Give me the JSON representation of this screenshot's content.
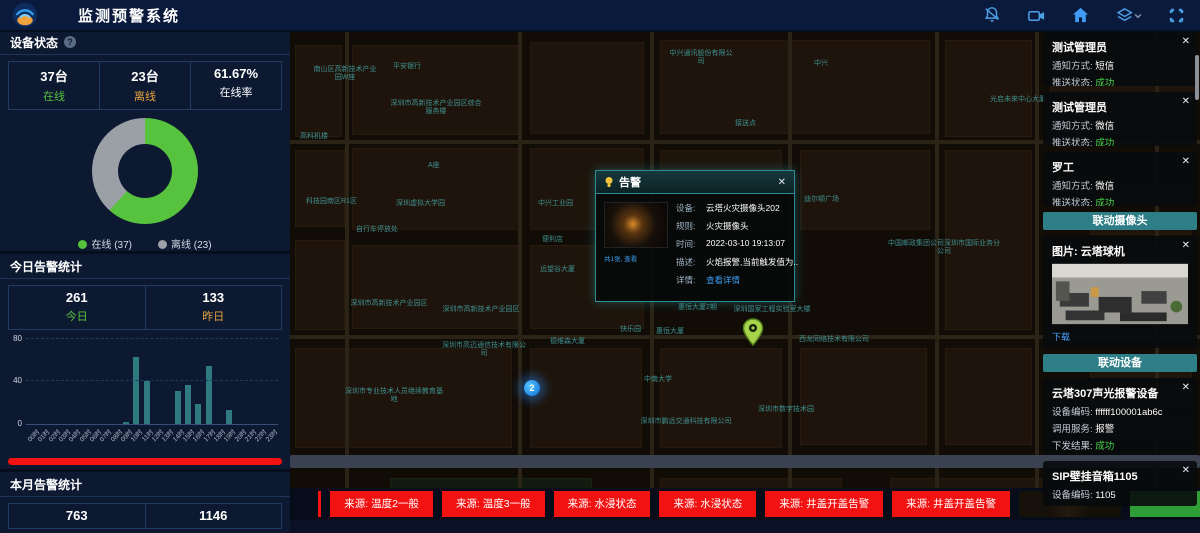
{
  "header": {
    "title": "监测预警系统",
    "icons": [
      {
        "name": "bell-off-icon"
      },
      {
        "name": "video-camera-icon"
      },
      {
        "name": "home-icon"
      },
      {
        "name": "layers-icon"
      },
      {
        "name": "fullscreen-icon"
      }
    ]
  },
  "device_status": {
    "title": "设备状态",
    "stats": [
      {
        "value": "37台",
        "label": "在线",
        "color": "#56c23d"
      },
      {
        "value": "23台",
        "label": "离线",
        "color": "#e8a33d"
      },
      {
        "value": "61.67%",
        "label": "在线率",
        "color": "#ffffff"
      }
    ]
  },
  "today_alerts": {
    "title": "今日告警统计",
    "stats": [
      {
        "value": "261",
        "label": "今日",
        "color": "#56c23d"
      },
      {
        "value": "133",
        "label": "昨日",
        "color": "#e8a33d"
      }
    ],
    "unhandled": "未处理(261个)",
    "handled": "已处理(0个)",
    "unhandled_color": "#f51212",
    "handled_color": "#49d349"
  },
  "month_alerts": {
    "title": "本月告警统计",
    "values": [
      "763",
      "1146"
    ]
  },
  "chart_data": [
    {
      "type": "pie",
      "donut": true,
      "title": "设备状态",
      "labels": [
        "在线",
        "离线"
      ],
      "values": [
        37,
        23
      ],
      "colors": [
        "#56c23d",
        "#9aa0a6"
      ],
      "legend": [
        "在线 (37)",
        "离线 (23)"
      ],
      "legend_position": "bottom"
    },
    {
      "type": "bar",
      "title": "今日告警统计(按小时)",
      "categories": [
        "00时",
        "01时",
        "02时",
        "03时",
        "04时",
        "05时",
        "06时",
        "07时",
        "08时",
        "09时",
        "10时",
        "11时",
        "12时",
        "13时",
        "14时",
        "15时",
        "16时",
        "17时",
        "18时",
        "19时",
        "20时",
        "21时",
        "22时",
        "23时"
      ],
      "values": [
        0,
        0,
        0,
        0,
        0,
        0,
        0,
        0,
        0,
        2,
        62,
        40,
        0,
        0,
        31,
        36,
        19,
        54,
        0,
        13,
        0,
        0,
        0,
        0
      ],
      "xlabel": "",
      "ylabel": "",
      "ylim": [
        0,
        80
      ],
      "yticks": [
        0,
        40,
        80
      ],
      "color": "#2e7a80",
      "grid": "dashed"
    }
  ],
  "map": {
    "cluster_count": "2",
    "labels": [
      {
        "x": 22,
        "y": 36,
        "w": 66,
        "t": "南山区高新技术产业园W座"
      },
      {
        "x": 103,
        "y": 33,
        "w": 0,
        "t": "平安银行"
      },
      {
        "x": 100,
        "y": 70,
        "w": 92,
        "t": "深圳市高新技术产业园区综合服务楼"
      },
      {
        "x": 10,
        "y": 103,
        "w": 0,
        "t": "高科机楼"
      },
      {
        "x": 16,
        "y": 168,
        "w": 0,
        "t": "科技园南区R1区"
      },
      {
        "x": 138,
        "y": 132,
        "w": 0,
        "t": "A座"
      },
      {
        "x": 106,
        "y": 170,
        "w": 0,
        "t": "深圳虚拟大学园"
      },
      {
        "x": 66,
        "y": 196,
        "w": 0,
        "t": "自行车停放处"
      },
      {
        "x": 248,
        "y": 170,
        "w": 0,
        "t": "中兴工业园"
      },
      {
        "x": 252,
        "y": 206,
        "w": 0,
        "t": "便利店"
      },
      {
        "x": 250,
        "y": 236,
        "w": 0,
        "t": "远望谷大厦"
      },
      {
        "x": 378,
        "y": 20,
        "w": 66,
        "t": "中兴通讯股份有限公司"
      },
      {
        "x": 524,
        "y": 30,
        "w": 0,
        "t": "中兴"
      },
      {
        "x": 700,
        "y": 66,
        "w": 0,
        "t": "光启未来中心大厦"
      },
      {
        "x": 445,
        "y": 90,
        "w": 0,
        "t": "接送点"
      },
      {
        "x": 58,
        "y": 270,
        "w": 82,
        "t": "深圳市高新技术产业园区"
      },
      {
        "x": 150,
        "y": 276,
        "w": 82,
        "t": "深圳市高新技术产业园区"
      },
      {
        "x": 55,
        "y": 358,
        "w": 98,
        "t": "深圳市专业技术人员继续教育基地"
      },
      {
        "x": 152,
        "y": 312,
        "w": 84,
        "t": "深圳市高迈通信技术有限公司"
      },
      {
        "x": 260,
        "y": 308,
        "w": 0,
        "t": "德维森大厦"
      },
      {
        "x": 330,
        "y": 296,
        "w": 0,
        "t": "快乐园"
      },
      {
        "x": 366,
        "y": 298,
        "w": 0,
        "t": "惠恒大厦"
      },
      {
        "x": 388,
        "y": 274,
        "w": 0,
        "t": "惠恒大厦2期"
      },
      {
        "x": 440,
        "y": 276,
        "w": 84,
        "t": "深圳国家工程实验室大楼"
      },
      {
        "x": 354,
        "y": 346,
        "w": 0,
        "t": "中南大学"
      },
      {
        "x": 350,
        "y": 388,
        "w": 92,
        "t": "深圳市鹏远交通科技有限公司"
      },
      {
        "x": 468,
        "y": 376,
        "w": 0,
        "t": "深圳市数字技术园"
      },
      {
        "x": 508,
        "y": 306,
        "w": 72,
        "t": "西龙同络技术有限公司"
      },
      {
        "x": 598,
        "y": 210,
        "w": 112,
        "t": "中国邮政集团公司深圳市国际业务分公司"
      },
      {
        "x": 514,
        "y": 166,
        "w": 0,
        "t": "迪尔顿广场"
      }
    ]
  },
  "popup": {
    "title": "告警",
    "close": "✕",
    "image_caption": "共1张, 查看",
    "fields": [
      {
        "label": "设备:",
        "value": "云塔火灾摄像头202",
        "link": false
      },
      {
        "label": "规则:",
        "value": "火灾摄像头",
        "link": false
      },
      {
        "label": "时间:",
        "value": "2022-03-10 19:13:07",
        "link": false
      },
      {
        "label": "描述:",
        "value": "火焰报警,当前触发值为...",
        "link": false
      },
      {
        "label": "详情:",
        "value": "查看详情",
        "link": true
      }
    ]
  },
  "right_panel": {
    "notifications": [
      {
        "title": "测试管理员",
        "rows": [
          [
            "通知方式:",
            "短信"
          ],
          [
            "推送状态:",
            "成功"
          ]
        ]
      },
      {
        "title": "测试管理员",
        "rows": [
          [
            "通知方式:",
            "微信"
          ],
          [
            "推送状态:",
            "成功"
          ]
        ]
      },
      {
        "title": "罗工",
        "rows": [
          [
            "通知方式:",
            "微信"
          ],
          [
            "推送状态:",
            "成功"
          ]
        ]
      }
    ],
    "camera_section": {
      "header": "联动摄像头",
      "card_title": "图片: 云塔球机",
      "action": "下载",
      "close": "✕"
    },
    "device_section": {
      "header": "联动设备",
      "cards": [
        {
          "title": "云塔307声光报警设备",
          "rows": [
            [
              "设备编码:",
              "ffffff100001ab6c"
            ],
            [
              "调用服务:",
              "报警"
            ],
            [
              "下发结果:",
              "成功"
            ]
          ]
        },
        {
          "title": "SIP壁挂音箱1105",
          "rows": [
            [
              "设备编码:",
              "1105"
            ]
          ]
        }
      ]
    }
  },
  "ticker": {
    "items": [
      "",
      "来源: 温度2一般",
      "来源: 温度3一般",
      "来源: 水浸状态",
      "来源: 水浸状态",
      "来源: 井盖开盖告警",
      "来源: 井盖开盖告警"
    ]
  },
  "colors": {
    "success": "#49d349",
    "alert_red": "#f31212",
    "teal_header": "#2d7e86",
    "bar_teal": "#2e7a80",
    "accent_blue": "#4d9fe8",
    "link_blue": "#3d9df0",
    "online_green": "#56c23d",
    "offline_gray": "#9aa0a6",
    "warn_orange": "#e8a33d"
  }
}
